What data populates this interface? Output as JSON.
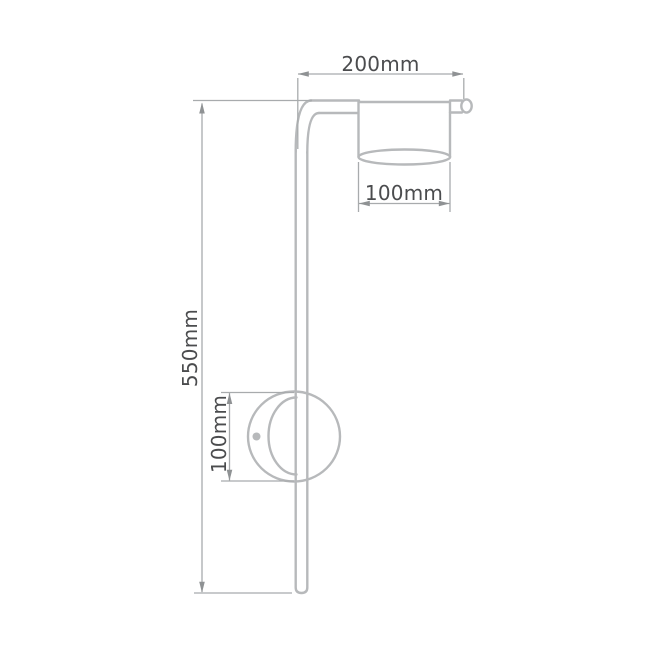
{
  "diagram": {
    "type": "technical-dimension-drawing",
    "subject": "wall-lamp",
    "labels": {
      "arm_reach": "200mm",
      "total_height": "550mm",
      "shade_diameter": "100mm",
      "mount_diameter": "100mm"
    },
    "colors": {
      "outline": "#b7b9bb",
      "dimension_line": "#a8abad",
      "arrow": "#8f9294",
      "text": "#4b4c4e",
      "background": "#ffffff"
    }
  }
}
